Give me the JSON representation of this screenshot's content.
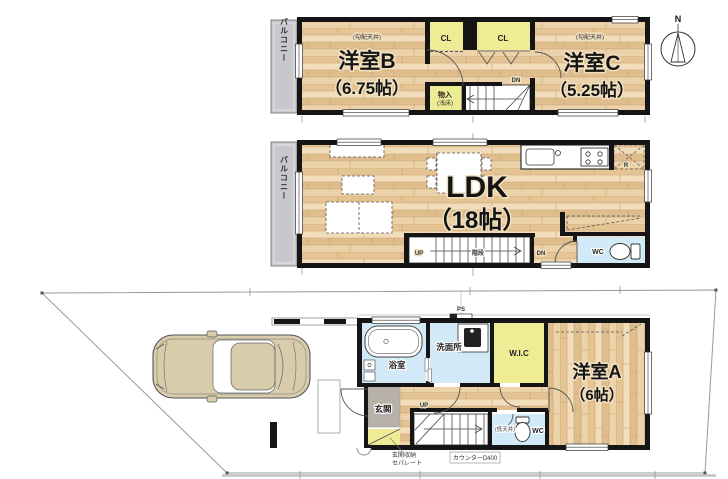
{
  "compass": {
    "north_label": "N"
  },
  "floor_3f": {
    "balcony_label": "バルコニー",
    "room_b": {
      "name": "洋室B",
      "size": "（6.75帖）",
      "ceiling_note": "(勾配天井)"
    },
    "closet_1_label": "CL",
    "closet_2_label": "CL",
    "storage": {
      "name": "物入",
      "note": "(浅床)"
    },
    "stairs_down_label": "DN",
    "room_c": {
      "name": "洋室C",
      "size": "（5.25帖）",
      "ceiling_note": "(勾配天井)"
    }
  },
  "floor_2f": {
    "balcony_label": "バルコニー",
    "ldk": {
      "name": "LDK",
      "size": "（18帖）"
    },
    "stairs": {
      "up_label": "UP",
      "name": "階段",
      "down_label": "DN"
    },
    "toilet_label": "WC",
    "refrigerator_label": "R"
  },
  "floor_1f": {
    "pipe_space_label": "PS",
    "washroom_label": "洗面所",
    "bathroom_label": "浴室",
    "walk_in_closet_label": "W.I.C",
    "room_a": {
      "name": "洋室A",
      "size": "（6帖）"
    },
    "entrance_label": "玄関",
    "stairs_up_label": "UP",
    "toilet": {
      "ceiling_note": "(低天井)",
      "label": "WC"
    },
    "entrance_storage_note": {
      "line1": "玄関収納",
      "line2": "セパレート"
    },
    "counter_note": "カウンターD400"
  },
  "colors": {
    "wall": "#151515",
    "wood_floor": "#e9cfa5",
    "closet_yellow": "#efec96",
    "wet_area_blue": "#d2e9f7",
    "balcony_gray": "#c7c7cc",
    "entrance_tile_gray": "#b7b1a7",
    "car_body": "#d9ccab"
  }
}
